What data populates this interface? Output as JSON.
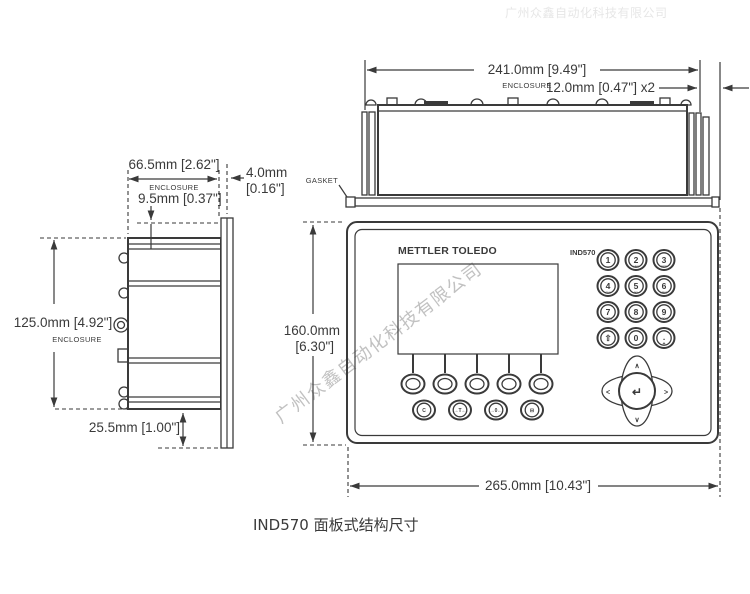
{
  "caption": "IND570 面板式结构尺寸",
  "watermark": {
    "diagonal_text": "广州众鑫自动化科技有限公司",
    "top_text": "广州众鑫自动化科技有限公司"
  },
  "top_view": {
    "width_dim": "241.0mm [9.49\"]",
    "enclosure_label": "ENCLOSURE",
    "bezel_overhang_dim": "12.0mm [0.47\"] x2",
    "gasket_label": "GASKET"
  },
  "side_view": {
    "depth_dim": "66.5mm [2.62\"]",
    "enclosure_label": "ENCLOSURE",
    "recess_dim": "9.5mm [0.37\"]",
    "bezel_dim_mm": "4.0mm",
    "bezel_dim_in": "[0.16\"]",
    "height_dim": "125.0mm [4.92\"]",
    "height_enclosure_label": "ENCLOSURE",
    "bottom_offset_dim": "25.5mm [1.00\"]"
  },
  "front_view": {
    "brand": "METTLER TOLEDO",
    "model": "IND570",
    "height_dim_mm": "160.0mm",
    "height_dim_in": "[6.30\"]",
    "width_dim": "265.0mm [10.43\"]",
    "numeric_keys": [
      {
        "digit": "1",
        "sub": ""
      },
      {
        "digit": "2",
        "sub": "ABC"
      },
      {
        "digit": "3",
        "sub": "DEF"
      },
      {
        "digit": "4",
        "sub": "GHI"
      },
      {
        "digit": "5",
        "sub": "JKL"
      },
      {
        "digit": "6",
        "sub": "MNO"
      },
      {
        "digit": "7",
        "sub": "PQRS"
      },
      {
        "digit": "8",
        "sub": "TUV"
      },
      {
        "digit": "9",
        "sub": "WXYZ"
      },
      {
        "digit": "⇧",
        "sub": ""
      },
      {
        "digit": "0",
        "sub": ""
      },
      {
        "digit": ".",
        "sub": "◂▸"
      }
    ],
    "function_keys": [
      {
        "name": "clear",
        "glyph": "C"
      },
      {
        "name": "tare",
        "glyph": "→T←"
      },
      {
        "name": "zero",
        "glyph": "→0←"
      },
      {
        "name": "print",
        "glyph": "⊟"
      }
    ],
    "nav": {
      "up": "∧",
      "down": "∨",
      "left": "<",
      "right": ">",
      "enter": "↵"
    }
  }
}
